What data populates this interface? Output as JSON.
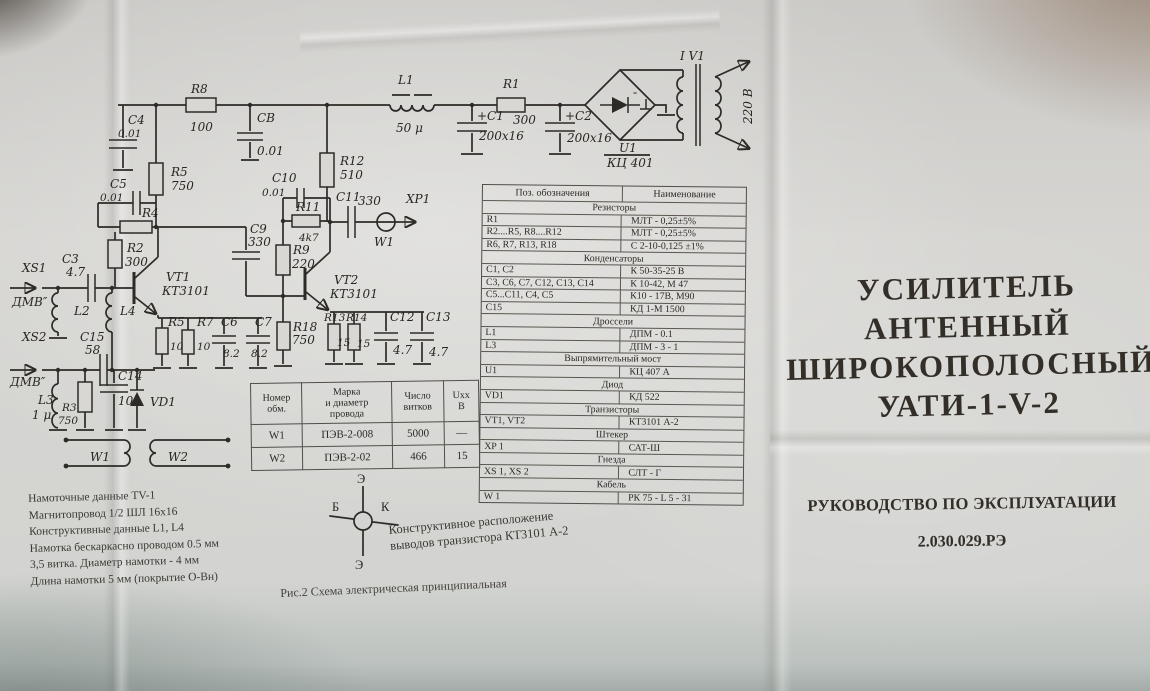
{
  "sch": {
    "c4": "C4",
    "c4_v": "0.01",
    "r8": "R8",
    "r8_v": "100",
    "c8": "CB",
    "c8_v": "0.01",
    "r5a": "R5",
    "r5a_v": "750",
    "c5": "C5",
    "c5_v": "0.01",
    "r4": "R4",
    "r2": "R2",
    "r2_v": "300",
    "c3": "C3",
    "c3_v": "4.7",
    "xs1": "XS1",
    "xs1_port": "ДМВ″",
    "l2": "L2",
    "l4": "L4",
    "vt1": "VT1",
    "vt1_type": "КТ3101",
    "r12": "R12",
    "r12_v": "510",
    "c10": "C10",
    "c10_v": "0.01",
    "r11": "R11",
    "r11_v": "4k7",
    "c11": "C11",
    "c11_v": "330",
    "xp1": "XP1",
    "w1_cable": "W1",
    "c9": "C9",
    "c9_v": "330",
    "r9": "R9",
    "r9_v": "220",
    "vt2": "VT2",
    "vt2_type": "КТ3101",
    "r18": "R18",
    "r18_v": "750",
    "xs2": "XS2",
    "xs2_port": "ДМВ″",
    "c15": "C15",
    "c15_v": "58",
    "l3": "L3",
    "l3_v": "1 μ",
    "r3": "R3",
    "r3_v": "750",
    "c14": "C14",
    "c14_v": "10",
    "vd1": "VD1",
    "r5b": "R5",
    "r5b_v": "10",
    "r7": "R7",
    "r7_v": "10",
    "c6": "C6",
    "c6_v": "8.2",
    "c7": "C7",
    "c7_v": "8.2",
    "r13": "R13",
    "r13_v": "15",
    "r14": "R14",
    "r14_v": "15",
    "c12": "C12",
    "c12_v": "4.7",
    "c13": "C13",
    "c13_v": "4.7",
    "l1": "L1",
    "l1_v": "50 μ",
    "r1": "R1",
    "r1_v": "300",
    "c1": "+C1",
    "c1_v": "200x16",
    "c2": "+C2",
    "c2_v": "200x16",
    "u1": "U1",
    "u1_type": "КЦ 401",
    "v1": "I V1",
    "v220": "220 В",
    "minus": "-",
    "w1_wind": "W1",
    "w2_wind": "W2"
  },
  "winding_table": {
    "headers": [
      "Номер\nобм.",
      "Марка\nи диаметр\nпровода",
      "Число\nвитков",
      "Uxx\nВ"
    ],
    "rows": [
      [
        "W1",
        "ПЭВ-2-008",
        "5000",
        "—"
      ],
      [
        "W2",
        "ПЭВ-2-02",
        "466",
        "15"
      ]
    ]
  },
  "parts_table": {
    "col1": "Поз. обозначения",
    "col2": "Наименование",
    "rows": [
      {
        "section": "Резисторы"
      },
      {
        "pos": "R1",
        "name": "МЛТ - 0,25±5%"
      },
      {
        "pos": "R2....R5, R8....R12",
        "name": "МЛТ - 0,25±5%"
      },
      {
        "pos": "R6, R7, R13, R18",
        "name": "С 2-10-0,125 ±1%"
      },
      {
        "section": "Конденсаторы"
      },
      {
        "pos": "C1, C2",
        "name": "К 50-35-25 В"
      },
      {
        "pos": "C3, C6, C7, C12, C13, C14",
        "name": "К 10-42, М 47"
      },
      {
        "pos": "C5...C11, C4, C5",
        "name": "К10 - 17В, М90"
      },
      {
        "pos": "C15",
        "name": "КД 1-М 1500"
      },
      {
        "section": "Дроссели"
      },
      {
        "pos": "L1",
        "name": "ДПМ - 0.1"
      },
      {
        "pos": "L3",
        "name": "ДПМ - 3 - 1"
      },
      {
        "section": "Выпрямительный мост"
      },
      {
        "pos": "U1",
        "name": "КЦ 407 А"
      },
      {
        "section": "Диод"
      },
      {
        "pos": "VD1",
        "name": "КД 522"
      },
      {
        "section": "Транзисторы"
      },
      {
        "pos": "VT1, VT2",
        "name": "КТ3101 А-2"
      },
      {
        "section": "Штекер"
      },
      {
        "pos": "XP 1",
        "name": "САТ-Ш"
      },
      {
        "section": "Гнезда"
      },
      {
        "pos": "XS 1, XS 2",
        "name": "СЛТ - Г"
      },
      {
        "section": "Кабель"
      },
      {
        "pos": "W 1",
        "name": "РК 75 - L 5 - 31"
      }
    ]
  },
  "title_block": {
    "line1": "УСИЛИТЕЛЬ",
    "line2": "АНТЕННЫЙ",
    "line3": "ШИРОКОПОЛОСНЫЙ",
    "line4": "УАТИ-1-V-2",
    "subtitle": "РУКОВОДСТВО ПО ЭКСПЛУАТАЦИИ",
    "doc_number": "2.030.029.РЭ"
  },
  "notes": {
    "lines": [
      "Намоточные данные TV-1",
      "Магнитопровод 1/2 ШЛ 16x16",
      "Конструктивные данные L1, L4",
      "Намотка бескаркасно проводом 0.5 мм",
      "3,5 витка. Диаметр намотки - 4 мм",
      "Длина намотки 5 мм (покрытие О-Вн)"
    ]
  },
  "pinout": {
    "top": "Э",
    "left": "Б",
    "right": "К",
    "bottom": "Э",
    "caption_line1": "Конструктивное расположение",
    "caption_line2": "выводов транзистора КТ3101 А-2"
  },
  "figure_caption": "Рис.2 Схема электрическая принципиальная"
}
